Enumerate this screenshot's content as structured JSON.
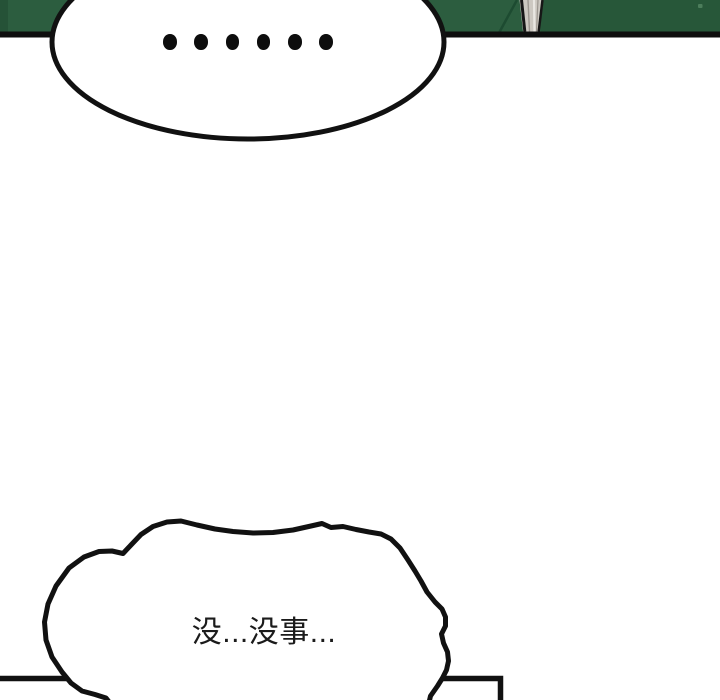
{
  "page": {
    "width": 720,
    "height": 700,
    "background": "#ffffff"
  },
  "panel_top": {
    "colors": {
      "green_left": "#2c5d3f",
      "green_right": "#275739",
      "edge_dark": "#255237",
      "border_black": "#0e0e0e",
      "fold_line": "#1d4b31",
      "blade_fill": "#ccc8c1",
      "blade_highlight": "#e9e7e2",
      "blade_shadow": "#9b968f",
      "blade_edge": "#161616",
      "speck_green": "#4c7d5b"
    }
  },
  "top_bubble": {
    "text": "......",
    "dot_count": 6,
    "fill": "#ffffff",
    "stroke": "#111111"
  },
  "bottom_bubble": {
    "text": "没...没事...",
    "fill": "#ffffff",
    "stroke": "#111111"
  },
  "panel_bottom": {
    "border_color": "#111111"
  }
}
